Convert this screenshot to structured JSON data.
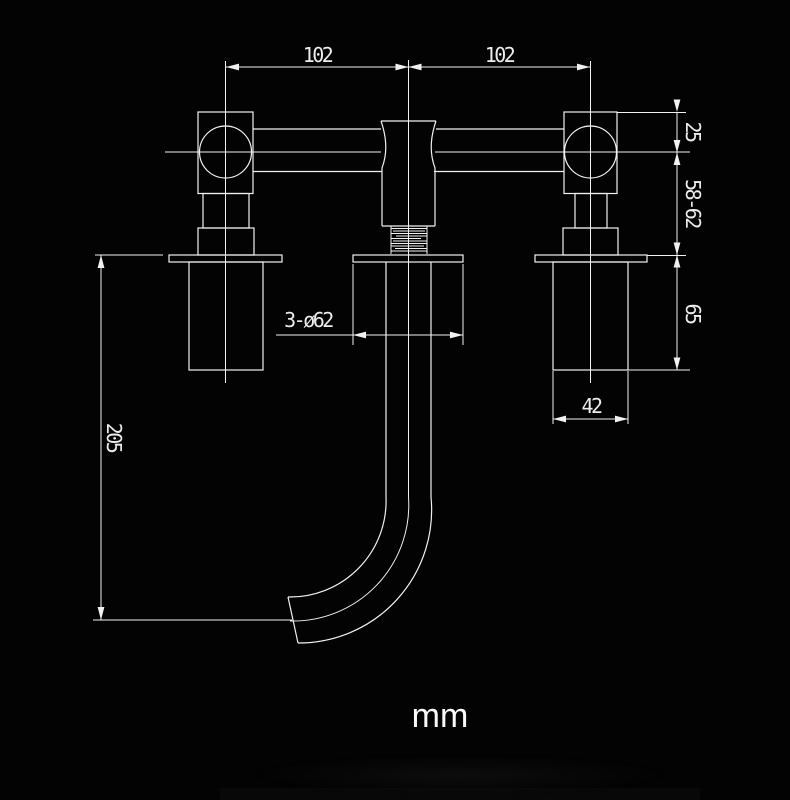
{
  "colors": {
    "background": "#030303",
    "line": "#f1f1f1",
    "text": "#ececec"
  },
  "unit_label": "mm",
  "dimensions": {
    "span_left": "102",
    "span_right": "102",
    "handle_height": "25",
    "depth_range": "58-62",
    "sleeve_length": "65",
    "spout_drop": "205",
    "escutcheon": "3-ø62",
    "sleeve_width": "42"
  }
}
